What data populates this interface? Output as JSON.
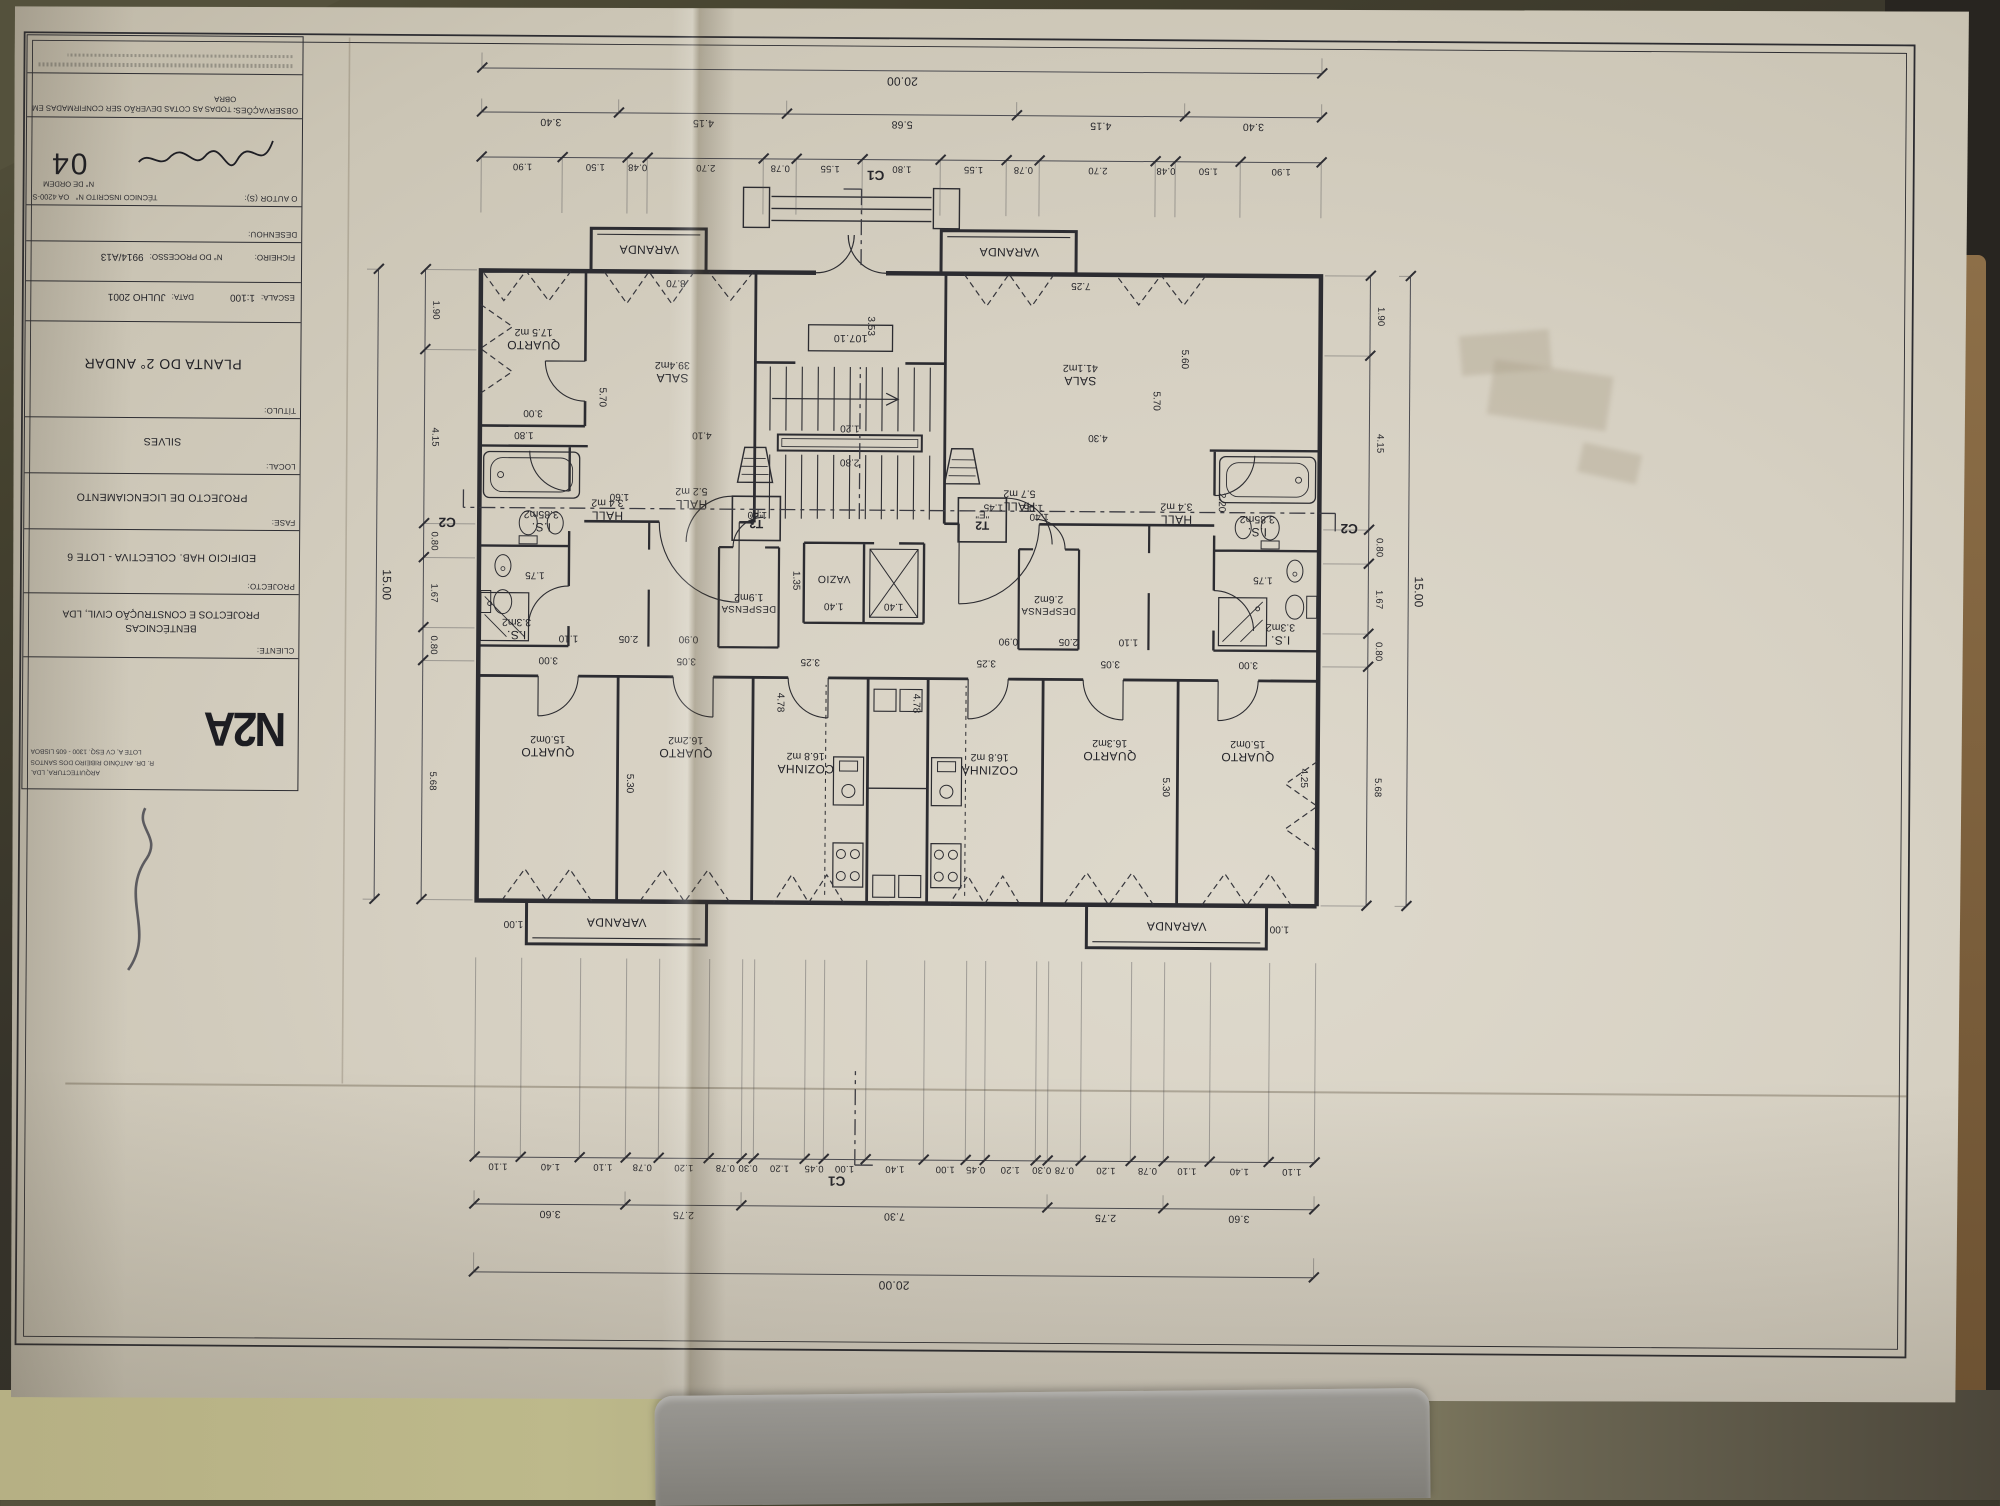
{
  "scene": {
    "paper_color": "#d6d0c2",
    "ink_color": "#2c2c31",
    "table_color": "#36332a",
    "floor_color": "#b6b084"
  },
  "titleblock": {
    "logo_text": "N2A",
    "logo_sub": "ARQUITECTURA, LDA.",
    "logo_addr1": "R. DR. ANTÓNIO RIBEIRO DOS SANTOS",
    "logo_addr2": "LOTE A, CV ESQ. 1300 - 605 LISBOA",
    "cliente_label": "CLIENTE:",
    "cliente_line1": "BENTÉCNICAS",
    "cliente_line2": "PROJECTOS E CONSTRUÇÃO CIVIL, LDA",
    "projecto_label": "PROJECTO:",
    "projecto": "EDIFICIO  HAB. COLECTIVA - LOTE 6",
    "fase_label": "FASE:",
    "fase": "PROJECTO DE LICENCIAMENTO",
    "local_label": "LOCAL:",
    "local": "SILVES",
    "titulo_label": "TÍTULO:",
    "titulo": "PLANTA DO 2° ANDAR",
    "escala_label": "ESCALA:",
    "escala": "1:100",
    "data_label": "DATA:",
    "data": "JULHO 2001",
    "ficheiro_label": "FICHEIRO:",
    "processo_label": "N° DO PROCESSO:",
    "processo": "9914/A13",
    "desenhou_label": "DESENHOU:",
    "autor_label": "O AUTOR (S):",
    "tecnico_label": "TÉCNICO INSCRITO N°",
    "tecnico": "OA 4200-S",
    "ordem_label": "N° DE ORDEM",
    "ordem": "04",
    "obs_label": "OBSERVAÇÕES:",
    "obs": "- TODAS AS COTAS DEVERÃO SER CONFIRMADAS EM OBRA"
  },
  "plan": {
    "level": "107.10",
    "sections": {
      "c1": "C1",
      "c2": "C2"
    },
    "core": {
      "vazio": "VAZIO",
      "t2": "T2",
      "t2_flag": "\"E\"",
      "t3": "T3",
      "t3_flag": "\"F\""
    },
    "left_unit": {
      "sala": {
        "name": "SALA",
        "area": "41.1m2"
      },
      "cozinha": {
        "name": "COZINHA",
        "area": "16.8 m2"
      },
      "quarto1": {
        "name": "QUARTO",
        "area": "16.3m2"
      },
      "quarto2": {
        "name": "QUARTO",
        "area": "15.0m2"
      },
      "hall": {
        "name": "HALL",
        "area": "5.7 m2"
      },
      "hall2": {
        "name": "HALL",
        "area": "3.4 m2"
      },
      "is1": {
        "name": "I.S.",
        "area": "3.85m2"
      },
      "is2": {
        "name": "I.S.",
        "area": "3.3m2"
      },
      "despensa": {
        "name": "DESPENSA",
        "area": "2.6m2"
      },
      "varanda1": {
        "name": "VARANDA"
      },
      "varanda2": {
        "name": "VARANDA"
      }
    },
    "right_unit": {
      "sala": {
        "name": "SALA",
        "area": "39.4m2"
      },
      "cozinha": {
        "name": "COZINHA",
        "area": "16.8 m2"
      },
      "quarto1": {
        "name": "QUARTO",
        "area": "16.2m2"
      },
      "quarto2": {
        "name": "QUARTO",
        "area": "15.0m2"
      },
      "quarto3": {
        "name": "QUARTO",
        "area": "17.5 m2"
      },
      "hall": {
        "name": "HALL",
        "area": "5.2 m2"
      },
      "hall2": {
        "name": "HALL",
        "area": "3.4 m2"
      },
      "is1": {
        "name": "I.S.",
        "area": "3.85m2"
      },
      "is2": {
        "name": "I.S.",
        "area": "3.3m2"
      },
      "despensa": {
        "name": "DESPENSA",
        "area": "1.9m2"
      },
      "varanda1": {
        "name": "VARANDA"
      },
      "varanda2": {
        "name": "VARANDA"
      }
    },
    "dims": {
      "top_small": [
        "1.10",
        "1.40",
        "1.10",
        "0.78",
        "1.20",
        "0.78",
        "0.30",
        "1.20",
        "0.45",
        "1.00",
        "1.40",
        "1.00",
        "0.45",
        "1.20",
        "0.30",
        "0.78",
        "1.20",
        "0.78",
        "1.10",
        "1.40",
        "1.10"
      ],
      "top_groups": [
        "3.60",
        "2.75",
        "7.30",
        "2.75",
        "3.60"
      ],
      "top_total": [
        "20.00"
      ],
      "bottom_small": [
        "1.90",
        "1.50",
        "0.48",
        "2.70",
        "0.78",
        "1.55",
        "1.80",
        "1.55",
        "0.78",
        "2.70",
        "0.48",
        "1.50",
        "1.90"
      ],
      "bottom_groups": [
        "3.40",
        "4.15",
        "5.68",
        "4.15",
        "3.40"
      ],
      "bottom_total": [
        "20.00"
      ],
      "side_small": [
        "5.68",
        "0.80",
        "1.67",
        "0.80",
        "4.15",
        "1.90"
      ],
      "side_total": [
        "15.00"
      ]
    },
    "fdims": [
      "3.00",
      "3.05",
      "3.25",
      "3.25",
      "3.05",
      "3.00",
      "5.30",
      "5.30",
      "4.78",
      "4.78",
      "4.25",
      "1.00",
      "1.00",
      "2.05",
      "2.05",
      "0.90",
      "0.90",
      "1.10",
      "1.10",
      "1.40",
      "1.40",
      "1.35",
      "1.40",
      "1.40",
      "2.20",
      "1.45",
      "1.05",
      "4.30",
      "4.10",
      "7.25",
      "8.70",
      "3.53",
      "5.70",
      "5.70",
      "5.60",
      "1.75",
      "1.75",
      "2.80",
      "1.20",
      "3.00",
      "1.80",
      "1.60"
    ]
  }
}
